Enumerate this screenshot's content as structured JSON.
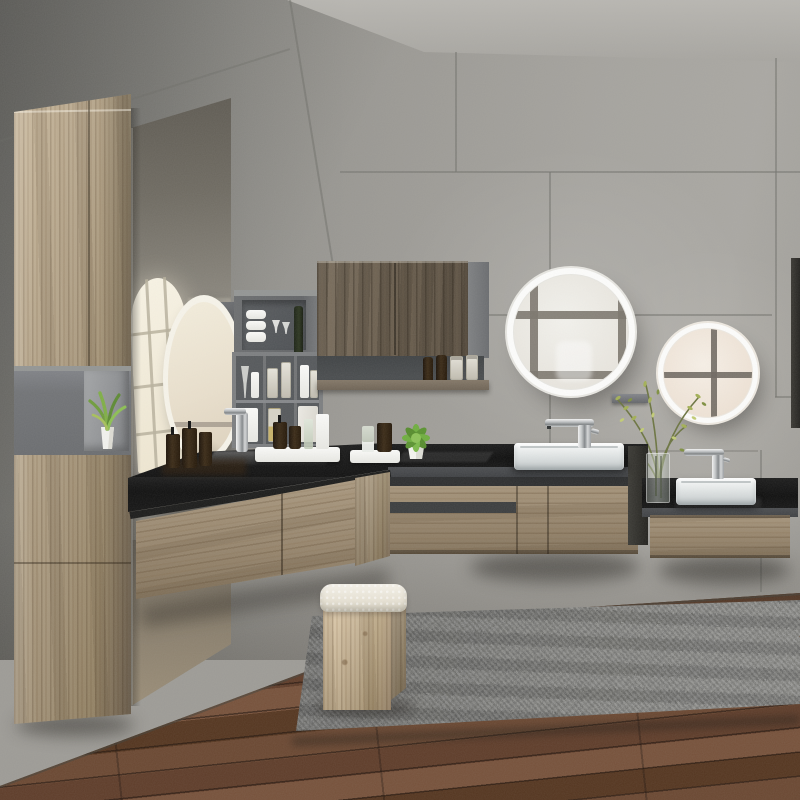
{
  "scene": {
    "title": "Modern concrete-wall bathroom with floating wood vanities, backlit round mirrors and a grey shag rug",
    "setting": "bathroom-interior-render",
    "lighting": "soft daylight reflected from windows",
    "objects": {
      "walls": "grey concrete tile panels with thin seams",
      "ceiling": "light grey concrete ceiling",
      "floor": "dark walnut plank flooring",
      "rug": "grey shag area rug",
      "tall_cabinet": "floating light-oak tall cabinet with open grey niche holding a potted plant",
      "mirror_panel": "full-height wall mirror reflecting a bright paned window",
      "left_round_mirror": "backlit round mirror seen edge-on above the corner vanity",
      "grey_shelves": "grey open cube shelves with towels, glasses, jars and dispensers",
      "corner_wall_cabinet": "dark-wood wall cabinet with open shelf of amber bottles and glass jars",
      "big_round_mirror": "large LED round mirror reflecting a four-pane window",
      "small_round_mirror": "smaller LED round mirror with warm tint and window cross reflection",
      "center_vanity": "floating oak vanity, black stone top, white rectangular vessel basin, chrome mixer",
      "right_vanity": "lower floating oak vanity, black stone top, white vessel basin, chrome mixer",
      "left_vanity": "corner oak vanity with glossy black top, soap bottles, trays and succulent",
      "stool": "light-oak waterfall stool with cream boucle cushion",
      "vase": "glass vase with wild olive-green branches",
      "wall_ledge": "small grey ledge between the two round mirrors",
      "dark_panel": "dark vertical panel at the right edge"
    },
    "counts": {
      "round_mirrors": 3,
      "visible_sinks": 2,
      "visible_faucets": 3,
      "vanity_units": 3,
      "amber_bottles": 9
    }
  },
  "palette": {
    "wall_grey": "#9d9b96",
    "wall_grey_dark": "#85837e",
    "ceiling_grey": "#b4b2ad",
    "seam_grey": "#75746f",
    "wood_light": "#b3a083",
    "wood_mid": "#98866c",
    "wood_dark": "#685c4c",
    "counter_black": "#121212",
    "counter_front_grey": "#46484b",
    "shelf_grey": "#797b7d",
    "shelf_grey_deep": "#55585b",
    "sink_white": "#f2f4f4",
    "chrome": "#c3c6c7",
    "mirror_cool_tint": "#edeeea",
    "mirror_warm_tint": "#f3eadf",
    "mirror_bar": "#7a746c",
    "led_ring": "#ffffff",
    "floor_brown": "#63432e",
    "floor_seam": "#38241a",
    "rug_grey": "#7d7d7b",
    "plant_green": "#7fae46",
    "branch_olive": "#a3b055",
    "cushion_cream": "#ece8dd",
    "glass_vase": "#c8d0c8"
  }
}
